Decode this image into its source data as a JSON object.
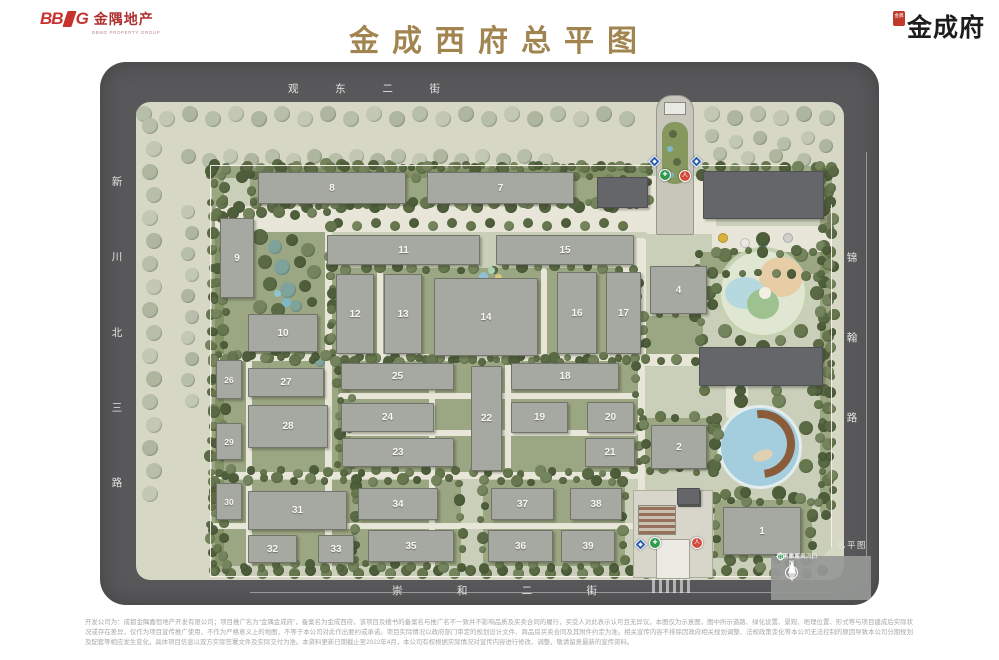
{
  "header": {
    "bbmg": {
      "bb": "BB",
      "g": "G",
      "cn": "金隅地产",
      "sub": "BBMG PROPERTY GROUP",
      "color": "#c8322e"
    },
    "title": {
      "text": "金成西府总平图",
      "color": "#a28451"
    },
    "brand": {
      "seal_text": "金隅",
      "name": "金成府"
    }
  },
  "map": {
    "streets": {
      "top": "观东二街",
      "left": "新川北三路",
      "right": "锦翰路",
      "bottom": "崇和二街"
    },
    "corner_label": "总平图",
    "legend": {
      "north_label": "N",
      "items": [
        {
          "label": "行人出入口",
          "type": "ped",
          "shape": "circle",
          "color": "#d24a3c"
        },
        {
          "label": "地下车库入口",
          "type": "garage",
          "shape": "diamond",
          "color": "#2f5fae"
        },
        {
          "label": "消防救援出入口",
          "type": "fire",
          "shape": "circle",
          "color": "#2f9a4e"
        }
      ]
    },
    "buildings": [
      {
        "label": "8",
        "x": 158,
        "y": 110,
        "w": 148,
        "h": 32
      },
      {
        "label": "7",
        "x": 327,
        "y": 110,
        "w": 147,
        "h": 32
      },
      {
        "label": "9",
        "x": 120,
        "y": 156,
        "w": 34,
        "h": 80
      },
      {
        "label": "10",
        "x": 148,
        "y": 252,
        "w": 70,
        "h": 38
      },
      {
        "label": "11",
        "x": 227,
        "y": 173,
        "w": 153,
        "h": 30
      },
      {
        "label": "15",
        "x": 396,
        "y": 173,
        "w": 138,
        "h": 30
      },
      {
        "label": "12",
        "x": 236,
        "y": 212,
        "w": 38,
        "h": 80
      },
      {
        "label": "13",
        "x": 284,
        "y": 212,
        "w": 38,
        "h": 80
      },
      {
        "label": "14",
        "x": 334,
        "y": 216,
        "w": 104,
        "h": 78
      },
      {
        "label": "16",
        "x": 457,
        "y": 210,
        "w": 40,
        "h": 82
      },
      {
        "label": "17",
        "x": 506,
        "y": 210,
        "w": 35,
        "h": 82
      },
      {
        "label": "4",
        "x": 550,
        "y": 204,
        "w": 57,
        "h": 48
      },
      {
        "label": "25",
        "x": 241,
        "y": 301,
        "w": 113,
        "h": 27
      },
      {
        "label": "18",
        "x": 411,
        "y": 301,
        "w": 108,
        "h": 27
      },
      {
        "label": "24",
        "x": 241,
        "y": 341,
        "w": 93,
        "h": 29
      },
      {
        "label": "19",
        "x": 411,
        "y": 340,
        "w": 57,
        "h": 31
      },
      {
        "label": "20",
        "x": 487,
        "y": 340,
        "w": 47,
        "h": 31
      },
      {
        "label": "23",
        "x": 242,
        "y": 376,
        "w": 112,
        "h": 29
      },
      {
        "label": "21",
        "x": 485,
        "y": 376,
        "w": 50,
        "h": 29
      },
      {
        "label": "22",
        "x": 371,
        "y": 304,
        "w": 31,
        "h": 105
      },
      {
        "label": "26",
        "x": 116,
        "y": 298,
        "w": 26,
        "h": 39
      },
      {
        "label": "27",
        "x": 148,
        "y": 306,
        "w": 76,
        "h": 29
      },
      {
        "label": "28",
        "x": 148,
        "y": 343,
        "w": 80,
        "h": 43
      },
      {
        "label": "29",
        "x": 116,
        "y": 361,
        "w": 26,
        "h": 37
      },
      {
        "label": "30",
        "x": 116,
        "y": 421,
        "w": 26,
        "h": 37
      },
      {
        "label": "31",
        "x": 148,
        "y": 429,
        "w": 99,
        "h": 39
      },
      {
        "label": "32",
        "x": 148,
        "y": 473,
        "w": 49,
        "h": 28
      },
      {
        "label": "33",
        "x": 218,
        "y": 473,
        "w": 36,
        "h": 28
      },
      {
        "label": "34",
        "x": 258,
        "y": 426,
        "w": 80,
        "h": 32
      },
      {
        "label": "35",
        "x": 268,
        "y": 468,
        "w": 86,
        "h": 32
      },
      {
        "label": "37",
        "x": 391,
        "y": 426,
        "w": 63,
        "h": 32
      },
      {
        "label": "36",
        "x": 388,
        "y": 468,
        "w": 65,
        "h": 32
      },
      {
        "label": "38",
        "x": 470,
        "y": 426,
        "w": 52,
        "h": 32
      },
      {
        "label": "39",
        "x": 461,
        "y": 468,
        "w": 54,
        "h": 32
      },
      {
        "label": "2",
        "x": 551,
        "y": 363,
        "w": 56,
        "h": 44
      },
      {
        "label": "1",
        "x": 623,
        "y": 445,
        "w": 78,
        "h": 48
      }
    ],
    "dark_buildings": [
      {
        "x": 497,
        "y": 115,
        "w": 51,
        "h": 31
      },
      {
        "x": 603,
        "y": 109,
        "w": 121,
        "h": 48
      },
      {
        "x": 599,
        "y": 285,
        "w": 124,
        "h": 39
      },
      {
        "x": 577,
        "y": 426,
        "w": 23,
        "h": 17
      }
    ],
    "markers": [
      {
        "type": "garage",
        "x": 554,
        "y": 99
      },
      {
        "type": "garage",
        "x": 596,
        "y": 99
      },
      {
        "type": "fire",
        "x": 565,
        "y": 113
      },
      {
        "type": "ped",
        "x": 585,
        "y": 114
      },
      {
        "type": "garage",
        "x": 540,
        "y": 482
      },
      {
        "type": "fire",
        "x": 555,
        "y": 481
      },
      {
        "type": "ped",
        "x": 597,
        "y": 481
      }
    ],
    "marker_glyphs": {
      "ped": "人",
      "fire": "✚",
      "garage": ""
    },
    "colors": {
      "road": "#58585a",
      "verge": "#d6d8c5",
      "ground": "#c9cfb9",
      "building": "#a6a8a2",
      "building_dark": "#64666a",
      "hedge": "#6e7e4c",
      "path": "#e8e6d8",
      "water": "#a4cedd",
      "deck": "#8a5c3a",
      "ped": "#d24a3c",
      "garage": "#2f5fae",
      "fire": "#2f9a4e",
      "title_gold": "#a28451",
      "brand_red": "#c8322e"
    }
  },
  "footer": {
    "disclaimer": "开发公司为：成都金隅嘉恒地产开发有限公司；项目推广名为“金隅金成府”，备案名为金成西府，该项目及楼书的备案名与推广名不一致并不影响品质及买卖合同的履行，买受人对此表示认可且无异议。本图仅为示意图，图中所示道路、绿化设置、景观、地理位置、形式等与项目建成后实际状况或存在差异，仅作为项目宣传推广使用，不作为严格意义上的地图，不等于本公司对此作出要约或承诺。项目实际情况以政府部门审定的规划设计文件、商品房买卖合同及其附件约定为准。相关宣传内容不排除因政府相关规划调整、法规政策变化等本公司无法控制的原因导致本公司分期规划及配套等相应发生变化，具体项目信息以双方实际签署文件及实际交付为准。本资料更新日期截止至2022年4月，本公司有权根据实际情况对宣传内容进行修改、调整，敬请留意最新的宣传资料。"
  }
}
